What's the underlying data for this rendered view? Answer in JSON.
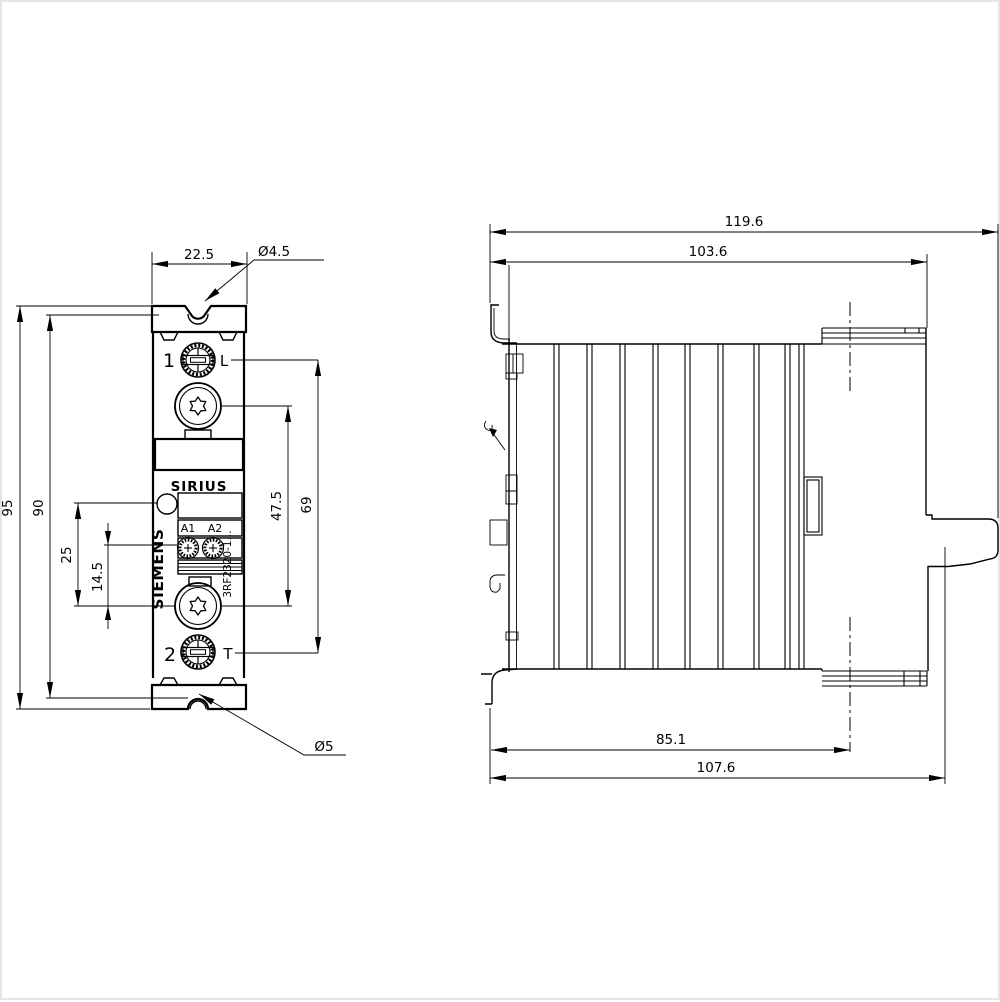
{
  "front_view": {
    "dims": {
      "width": "22.5",
      "top_hole_dia": "Ø4.5",
      "bottom_hole_dia": "Ø5",
      "overall_height": "95",
      "mounting_hole_spacing": "90",
      "led_to_screw": "25",
      "coil_terminal_to_screw": "14.5",
      "screw_spacing": "47.5",
      "main_terminal_spacing": "69"
    },
    "device": {
      "brand": "SIEMENS",
      "family": "SIRIUS",
      "article_number": "3RF2320-1...",
      "terminal_top": "1",
      "terminal_bottom": "2",
      "marker_line": "L",
      "marker_load": "T",
      "coil_a1": "A1",
      "coil_a2": "A2"
    }
  },
  "side_view": {
    "dims": {
      "overall_depth": "119.6",
      "housing_depth": "103.6",
      "rail_to_front": "85.1",
      "depth_without_connector": "107.6"
    }
  }
}
